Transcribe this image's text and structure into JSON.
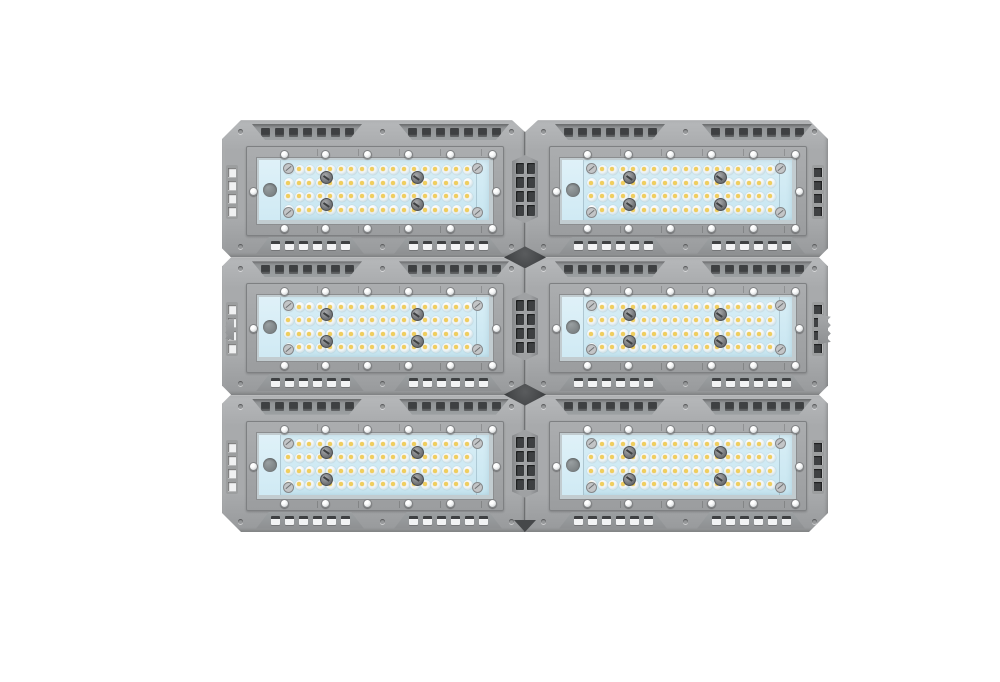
{
  "scene": {
    "kind": "product-photo",
    "subject": "modular-led-flood-light"
  },
  "fixture": {
    "module_grid": {
      "rows": 3,
      "cols": 2
    },
    "module": {
      "led_array": {
        "rows": 4,
        "cols": 18
      },
      "top_vent": {
        "groups": 2,
        "holes_per_group": 7
      },
      "bottom_vent": {
        "groups": 2,
        "holes_per_group": 6
      },
      "frame_screws": {
        "top": 6,
        "bottom": 6,
        "mid_sides": 2
      },
      "panel_screws": 4,
      "glass_corner_screws": 4,
      "edge_screws_per_edge": 3,
      "side_slots": 4,
      "port_holes": 1
    },
    "center_vent": {
      "cols": 2,
      "rows": 4
    },
    "mounting_tabs": {
      "left": 1,
      "right": 1
    },
    "colors": {
      "background": "#ffffff",
      "housing": "#a8aaac",
      "housing_light": "#b6b8ba",
      "housing_dark": "#97999b",
      "recess_top": "#8e9092",
      "recess_bottom": "#9ca0a2",
      "hole_dark": "#3e4042",
      "hole_light": "#f2f3f4",
      "frame": "#a3a5a7",
      "frame_border": "#7e8082",
      "bezel": "#c2ccd0",
      "bezel_border": "#8b8d8f",
      "glass_top": "#d8eef6",
      "glass_bottom": "#c8e6f1",
      "glass_strip": "#dff1f8",
      "led_base": "#eef4f6",
      "led_ring": "#c0d3d9",
      "led_dot": "#f0ce5e",
      "screw_face": "#eceeef",
      "screw_border": "#7f8183",
      "panel_screw": "#75777a",
      "port": "#7e8486",
      "seam": "#737577",
      "junction": "#46484a",
      "slot_light": "#f0f1f2",
      "slot_dark": "#3f4143"
    }
  }
}
